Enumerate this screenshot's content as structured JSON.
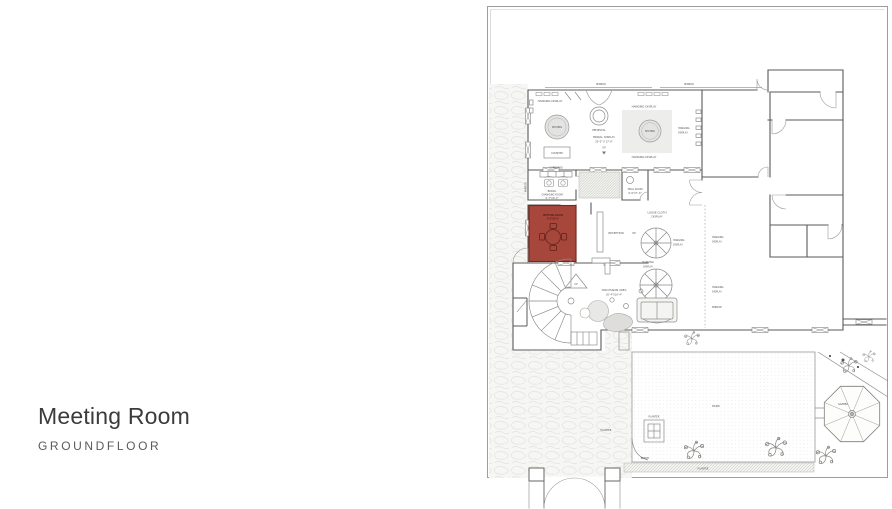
{
  "slide": {
    "title": "Meeting Room",
    "subtitle": "GROUNDFLOOR"
  },
  "colors": {
    "meeting_room_fill": "#a7463b",
    "meeting_room_line": "#6e2a21",
    "meeting_room_border": "#74291f"
  },
  "plan": {
    "labels": {
      "mirror": "MIRROR",
      "hanging_display": "HANGING DISPLAY",
      "hanging": "HANGING",
      "display": "DISPLAY",
      "seating": "SEATING",
      "pedestal": "PEDESTAL",
      "bridal_display": "BRIDAL DISPLAY",
      "bridal_display_dims": "20'-0\" X 17'-0\"",
      "up": "UP",
      "counter": "COUNTER",
      "cupboard": "CUPBOARD",
      "bridal": "BRIDAL",
      "changing_room": "CHANGING ROOM",
      "bridal_changing_dims": "6'-7\"X6'-0\"",
      "trial_room": "TRIAL ROOM",
      "trial_room_dims": "6'-6\"X7'-0\"",
      "meeting_room": "MEETING ROOM",
      "meeting_room_dims": "6'-0\"X6'-6\"",
      "reception": "RECEPTION",
      "loose_cloth": "LOOSE CLOTH",
      "discussion_area": "DISCUSSION AREA",
      "discussion_dims": "20'-4\"X16'-4\"",
      "park": "PARK",
      "planter": "PLANTER",
      "bench": "BENCH",
      "gazebo": "GAZEBO"
    }
  }
}
